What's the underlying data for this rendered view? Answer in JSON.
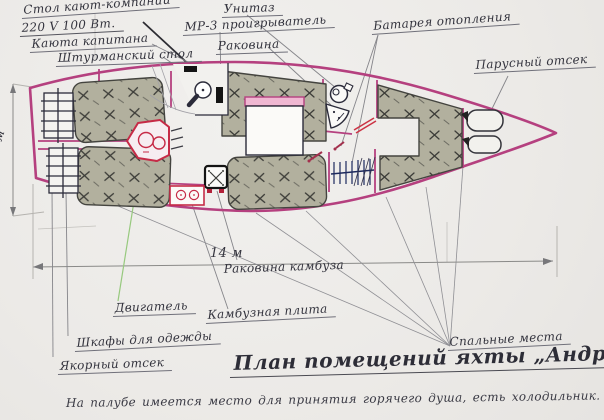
{
  "document": {
    "title": "План помещений яхты „Андромеда“",
    "footnote": "На палубе имеется место для принятия горячего душа, есть холодильник.",
    "dimensions": {
      "beam": "3.20 м",
      "length": "14 м"
    },
    "callouts": {
      "saloon_table": "Стол кают-компании",
      "power_rating": "220 V 100 Вт.",
      "captain_cabin": "Каюта капитана",
      "nav_table": "Штурманский стол",
      "toilet": "Унитаз",
      "mp3_player": "МР-3 проигрыватель",
      "sink": "Раковина",
      "heating_radiator": "Батарея отопления",
      "sail_locker": "Парусный отсек",
      "galley_sink": "Раковина камбуза",
      "engine": "Двигатель",
      "galley_stove": "Камбузная плита",
      "wardrobes": "Шкафы для одежды",
      "anchor_locker": "Якорный отсек",
      "berths": "Спальные места"
    },
    "colors": {
      "hull_outline": "#b5407f",
      "berth_fill": "#b2b09e",
      "hatch_ink": "#3c3c38",
      "engine_red": "#c62b47",
      "paper": "#edecea",
      "ink": "#34343e",
      "engine_leader_green": "#97c97e"
    }
  }
}
